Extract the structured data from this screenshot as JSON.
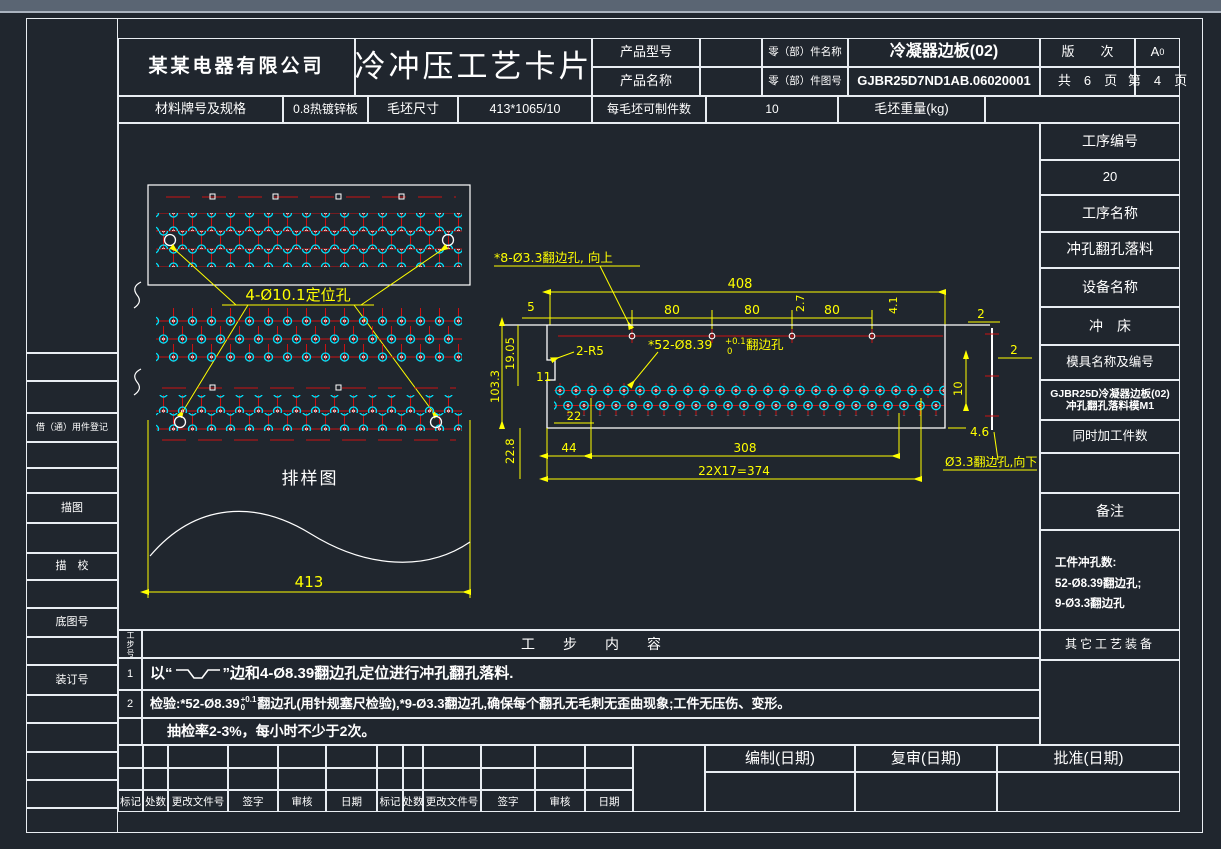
{
  "colors": {
    "background": "#20262e",
    "line": "#e9edf2",
    "dim_yellow": "#ffff00",
    "hole_red": "#dd0000",
    "hole_cyan": "#00ffff",
    "titlebar": "#5a6573"
  },
  "header": {
    "company": "某某电器有限公司",
    "doc_title": "冷冲压工艺卡片",
    "product_model_label": "产品型号",
    "product_model_value": "",
    "product_name_label": "产品名称",
    "product_name_value": "",
    "part_name_label": "零（部）件名称",
    "part_name_value": "冷凝器边板(02)",
    "part_no_label": "零（部）件图号",
    "part_no_value": "GJBR25D7ND1AB.06020001",
    "version_label": "版　　次",
    "version_value_main": "A",
    "version_value_sub": "0",
    "total_pages": "共　6　页",
    "current_page": "第　4　页"
  },
  "material": {
    "grade_label": "材料牌号及规格",
    "grade_value": "0.8热镀锌板",
    "blank_size_label": "毛坯尺寸",
    "blank_size_value": "413*1065/10",
    "parts_per_blank_label": "每毛坯可制件数",
    "parts_per_blank_value": "10",
    "blank_weight_label": "毛坯重量(kg)",
    "blank_weight_value": ""
  },
  "left_sidebar": {
    "borrow_label": "借（通）用件登记",
    "trace_label": "描图",
    "trace_check_label": "描　校",
    "base_drawing_no_label": "底图号",
    "binding_no_label": "装订号"
  },
  "right_panel": {
    "process_no_label": "工序编号",
    "process_no_value": "20",
    "process_name_label": "工序名称",
    "process_name_value": "冲孔翻孔落料",
    "equipment_label": "设备名称",
    "equipment_value": "冲　床",
    "mold_label": "模具名称及编号",
    "mold_value_line1": "GJBR25D冷凝器边板(02)",
    "mold_value_line2": "冲孔翻孔落料模M1",
    "simultaneous_label": "同时加工件数",
    "simultaneous_value": "",
    "remark_label": "备注",
    "remark_line1": "工件冲孔数:",
    "remark_line2": "52-Ø8.39翻边孔;",
    "remark_line3": "9-Ø3.3翻边孔",
    "other_tooling_label": "其它工艺装备"
  },
  "steps": {
    "no_col_header": "工步号",
    "content_header": "工　　步　　内　　容",
    "row1_no": "1",
    "row1_prefix": "以“",
    "row1_suffix": "”边和4-Ø8.39翻边孔定位进行冲孔翻孔落料.",
    "row2_no": "2",
    "row2_seg1": "检验:*52-Ø8.39",
    "row2_tol_sup": "+0.1",
    "row2_tol_sub": "0",
    "row2_seg2": "翻边孔(用针规塞尺检验),*9-Ø3.3翻边孔,确保每个翻孔无毛刺无歪曲现象;工件无压伤、变形。",
    "row3_no": "",
    "row3_text": "抽检率2-3%，每小时不少于2次。"
  },
  "signature": {
    "labels": [
      "标记",
      "处数",
      "更改文件号",
      "签字",
      "审核",
      "日期"
    ],
    "prepare_label": "编制(日期)",
    "review_label": "复审(日期)",
    "approve_label": "批准(日期)"
  },
  "layout_drawing": {
    "positioning_hole_note": "4-Ø10.1定位孔",
    "title": "排样图",
    "width_dim": "413"
  },
  "part_drawing": {
    "note_top": "*8-Ø3.3翻边孔, 向上",
    "note_mid_prefix": "*52-Ø8.39",
    "note_mid_tol_sup": "+0.1",
    "note_mid_tol_sub": "0",
    "note_mid_suffix": "翻边孔",
    "note_bottom": "Ø3.3翻边孔,向下",
    "dim_408": "408",
    "dim_80_1": "80",
    "dim_80_2": "80",
    "dim_80_3": "80",
    "dim_5": "5",
    "dim_2_7": "2.7",
    "dim_4_1": "4.1",
    "dim_2_a": "2",
    "dim_2_b": "2",
    "dim_19_05": "19.05",
    "dim_103_3": "103.3",
    "dim_11": "11",
    "dim_2r5": "2-R5",
    "dim_22": "22",
    "dim_44": "44",
    "dim_308": "308",
    "dim_374": "22X17=374",
    "dim_22_8": "22.8",
    "dim_10": "10",
    "dim_4_6": "4.6"
  }
}
